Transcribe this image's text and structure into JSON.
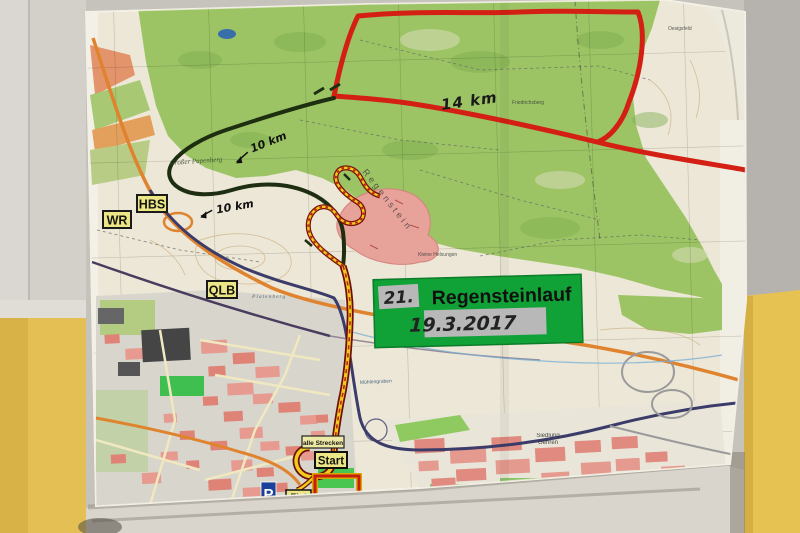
{
  "sign": {
    "race_number": "21.",
    "race_name": "Regensteinlauf",
    "race_date": "19.3.2017"
  },
  "distances": {
    "long": "14 km",
    "medium_upper": "10 km",
    "medium_lower": "10 km"
  },
  "destination_signs": {
    "hbs": "HBS",
    "wr": "WR",
    "qlb": "QLB"
  },
  "course_signs": {
    "all_tracks": "alle Strecken",
    "start": "Start",
    "finish": "Ziel",
    "parking": "P"
  },
  "map_labels": {
    "grosser_papenberg": "Großer Papenberg",
    "regenstein": "Regenstein",
    "friedrichsberg": "Friedrichsberg",
    "kleine_helsungen": "Kleine Helsungen",
    "platenberg": "Platenberg",
    "muehlengraben": "Mühlengraben",
    "siedlung": "Siedlung",
    "gehren": "Gehren",
    "oesigsfeld": "Oesigsfeld"
  },
  "colors": {
    "route_long": "#d42014",
    "route_medium": "#1e2e10",
    "route_all_core": "#eecb1c",
    "route_all_edge": "#6e0e06",
    "sign_green": "#11a237",
    "sign_plate": "#ece687",
    "wall_yellow": "#e4c054",
    "forest_green": "#9cc464"
  }
}
